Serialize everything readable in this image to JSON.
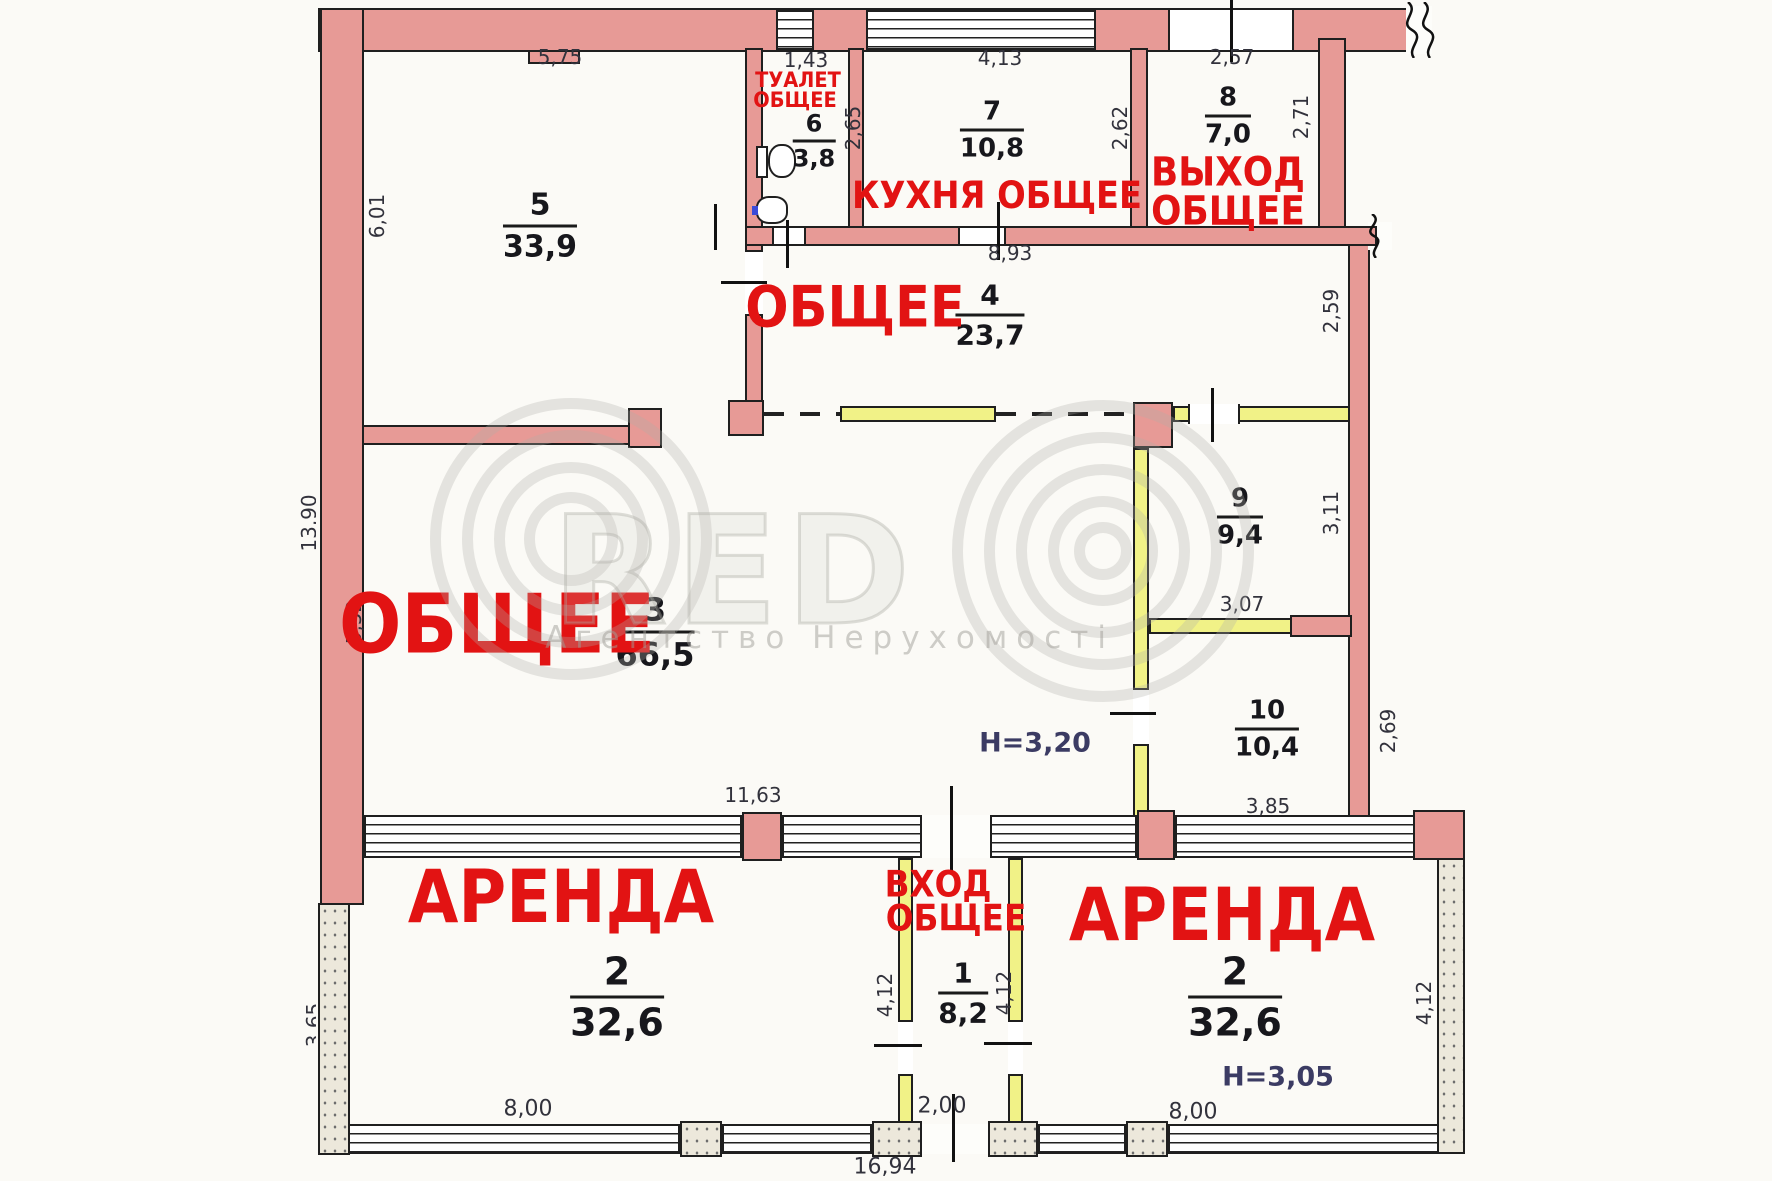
{
  "rooms": {
    "r5": {
      "number": "5",
      "area": "33,9"
    },
    "r6": {
      "label1": "ТУАЛЕТ",
      "label2": "ОБЩЕЕ",
      "number": "6",
      "area": "3,8"
    },
    "r7": {
      "label": "КУХНЯ ОБЩЕЕ",
      "number": "7",
      "area": "10,8"
    },
    "r8": {
      "label1": "ВЫХОД",
      "label2": "ОБЩЕЕ",
      "number": "8",
      "area": "7,0"
    },
    "r4": {
      "label": "ОБЩЕЕ",
      "number": "4",
      "area": "23,7"
    },
    "r3": {
      "label": "ОБЩЕЕ",
      "number": "3",
      "area": "66,5",
      "ceiling_height": "H=3,20"
    },
    "r9": {
      "number": "9",
      "area": "9,4"
    },
    "r10": {
      "number": "10",
      "area": "10,4"
    },
    "r1": {
      "label1": "ВХОД",
      "label2": "ОБЩЕЕ",
      "number": "1",
      "area": "8,2"
    },
    "r2a": {
      "label": "АРЕНДА",
      "number": "2",
      "area": "32,6"
    },
    "r2b": {
      "label": "АРЕНДА",
      "number": "2",
      "area": "32,6",
      "ceiling_height": "H=3,05"
    }
  },
  "dimensions": {
    "top_r5": "5,75",
    "top_r6": "1,43",
    "top_r7": "4,13",
    "top_r8": "2,57",
    "left_r5": "6,01",
    "left_r3": "5,52",
    "r6_right": "2,65",
    "r7_right": "2,62",
    "r8_right": "2,71",
    "r4_width": "8,93",
    "r4_right": "2,59",
    "r9_right": "3,11",
    "r9_bottom": "3,07",
    "r10_right": "2,69",
    "r10_bottom": "3,85",
    "r3_bottom": "11,63",
    "r1_left": "4,12",
    "r1_right": "4,12",
    "r2b_right": "4,12",
    "r2a_bottom": "8,00",
    "r1_bottom": "2,00",
    "r2b_bottom": "8,00",
    "total_bottom": "16,94",
    "left_edge_upper": "13,90",
    "left_edge_lower": "3,65"
  },
  "watermark": {
    "letters": "RED",
    "subtitle": "Агентство Нерухомості"
  }
}
